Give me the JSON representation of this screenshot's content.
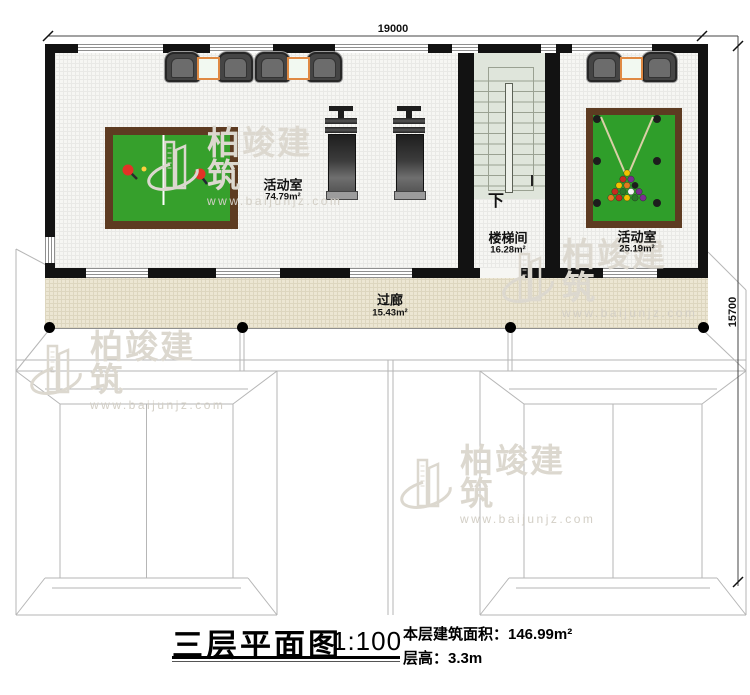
{
  "plan": {
    "dimensions": {
      "width_label": "19000",
      "height_label": "15700"
    },
    "rooms": {
      "activity_large": {
        "name": "活动室",
        "area": "74.79m²"
      },
      "stairwell": {
        "name": "楼梯间",
        "area": "16.28m²"
      },
      "activity_small": {
        "name": "活动室",
        "area": "25.19m²"
      },
      "corridor": {
        "name": "过廊",
        "area": "15.43m²"
      }
    },
    "stairs": {
      "direction_label": "下"
    }
  },
  "title_block": {
    "title": "三层平面图",
    "scale": "1:100",
    "floor_area": "本层建筑面积：146.99m²",
    "floor_height": "层高：3.3m"
  },
  "watermark": {
    "brand": "柏竣建筑",
    "url": "www.baijunjz.com"
  },
  "colors": {
    "wall": "#121212",
    "table_green": "#36a02c",
    "table_wood": "#5d3b21",
    "corridor_fill": "#ece6d3",
    "stair_fill": "#dfe5db",
    "accent_orange": "#e08a43",
    "watermark": "#dcd8cf",
    "watermark_url": "#d3cfc6",
    "roofline": "#b6b6b6"
  },
  "pool_balls": [
    "#f2c200",
    "#c82a1e",
    "#7b2f90",
    "#f2c200",
    "#e07a1e",
    "#1d1d1d",
    "#c82a1e",
    "#2a7a2a",
    "#f5f5f5",
    "#7b2f90",
    "#e07a1e",
    "#c82a1e",
    "#f2c200",
    "#2a7a2a",
    "#7b2f90"
  ]
}
